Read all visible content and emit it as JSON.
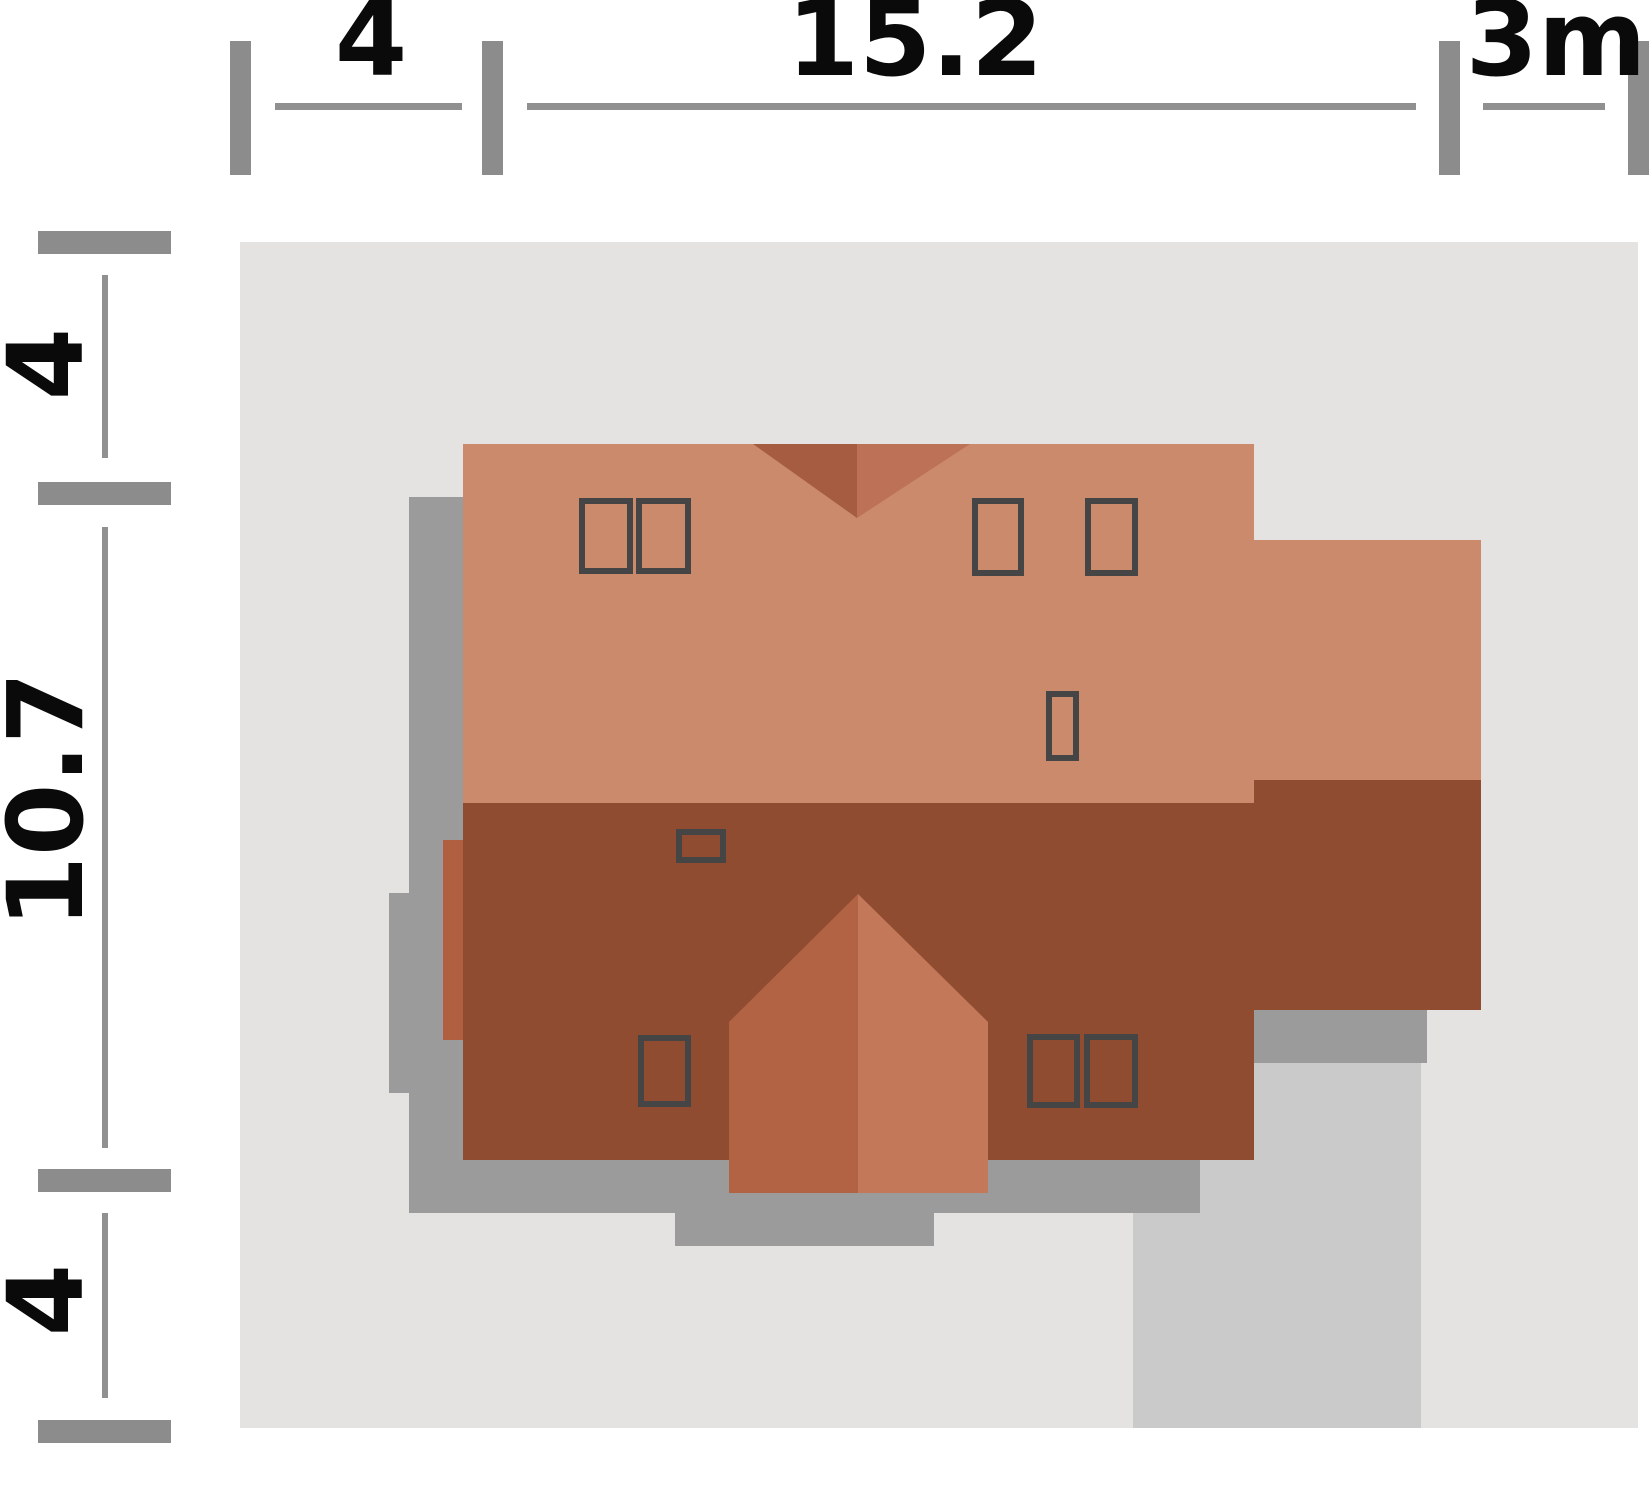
{
  "plan_title": "house-roof-site-plan",
  "dimensions": {
    "unit_note": "m",
    "top": [
      {
        "label": "4"
      },
      {
        "label": "15.2"
      },
      {
        "label": "3m"
      }
    ],
    "left": [
      {
        "label": "4"
      },
      {
        "label": "10.7"
      },
      {
        "label": "4"
      }
    ]
  },
  "colors": {
    "background": "#ffffff",
    "plot": "#e4e3e2",
    "driveway": "#cbcaca",
    "shadow": "#9c9b9b",
    "roof_light": "#cb8a6c",
    "roof_dark": "#8f4c30",
    "valley_dark": "#a55c40",
    "valley_light": "#bd7257",
    "gable_left": "#b26344",
    "gable_right": "#c3785a",
    "chimney": "#b05f41",
    "skylight_border": "#454545",
    "dimension_gray": "#8c8c8c",
    "dimension_line": "#909090",
    "label_black": "#0a0a0a"
  },
  "plan": {
    "roof_window_count": 9,
    "elements": [
      "plot-boundary",
      "driveway",
      "house-shadow",
      "upper-roof-plane",
      "lower-roof-plane",
      "side-wing-roof",
      "rear-roof-valley",
      "front-gable",
      "chimney",
      "roof-windows"
    ]
  }
}
